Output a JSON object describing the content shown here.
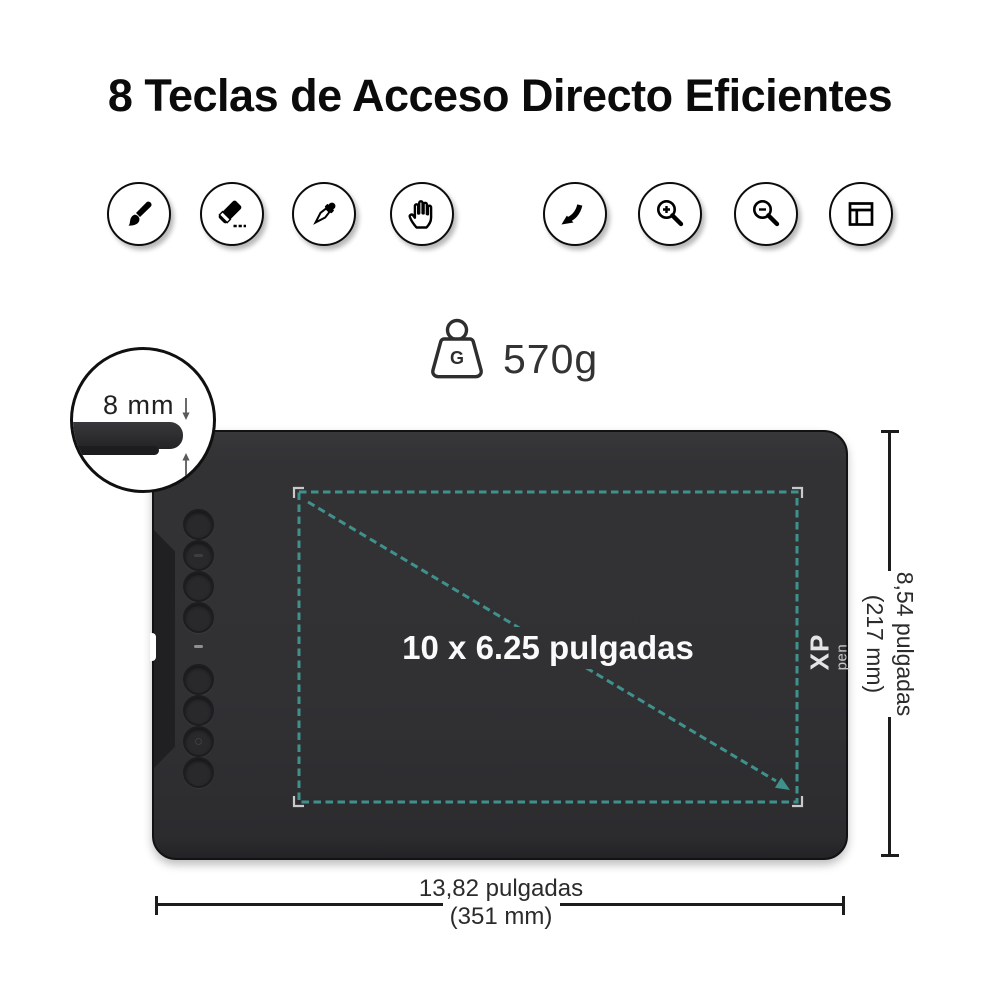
{
  "title": "8 Teclas de Acceso Directo Eficientes",
  "shortcut_icons": {
    "group1": [
      "brush",
      "eraser",
      "eyedropper",
      "hand"
    ],
    "group2": [
      "undo",
      "zoom-in",
      "zoom-out",
      "window-layout"
    ]
  },
  "weight": {
    "value": "570g",
    "icon_letter": "G"
  },
  "thickness": {
    "label": "8 mm"
  },
  "tablet": {
    "active_area_label": "10 x 6.25 pulgadas",
    "logo": {
      "line1": "XP",
      "line2": "pen"
    },
    "shortcut_buttons_count": 8
  },
  "dimensions": {
    "height_in": "8,54 pulgadas",
    "height_mm": "(217 mm)",
    "width_in": "13,82 pulgadas",
    "width_mm": "(351 mm)"
  },
  "colors": {
    "accent_teal": "#3f918c",
    "tablet_body": "#323234",
    "bracket_gray": "#c9c9c9"
  }
}
